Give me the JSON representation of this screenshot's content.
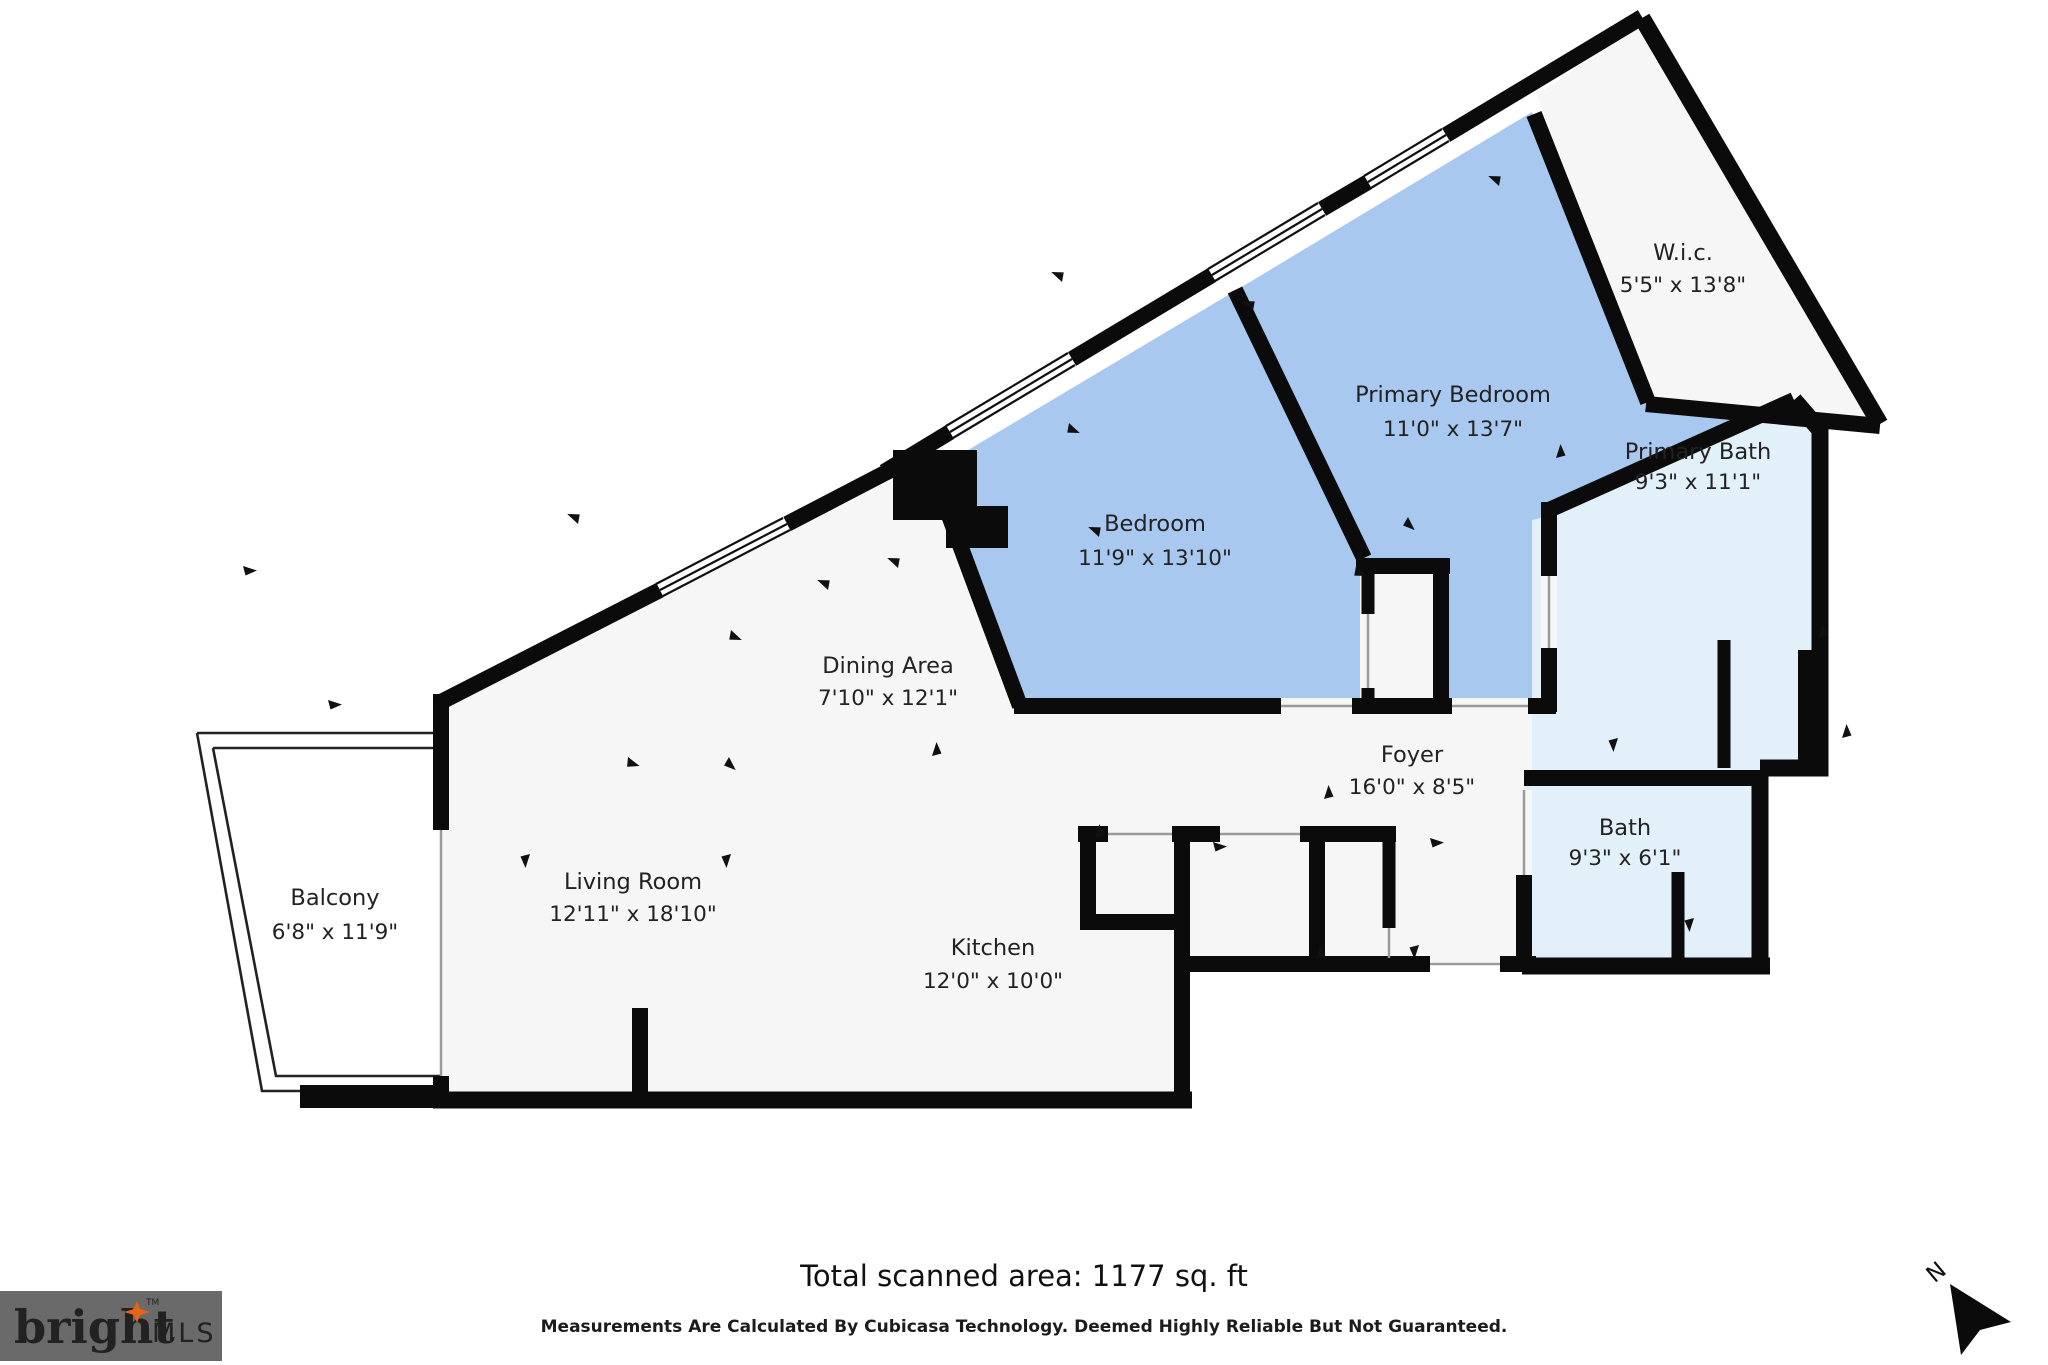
{
  "title": "Floor plan",
  "rooms": [
    {
      "id": "wic",
      "name": "W.i.c.",
      "dims": "5'5\" x 13'8\""
    },
    {
      "id": "primary-bedroom",
      "name": "Primary Bedroom",
      "dims": "11'0\" x 13'7\""
    },
    {
      "id": "bedroom",
      "name": "Bedroom",
      "dims": "11'9\" x 13'10\""
    },
    {
      "id": "dining-area",
      "name": "Dining Area",
      "dims": "7'10\" x 12'1\""
    },
    {
      "id": "living-room",
      "name": "Living Room",
      "dims": "12'11\" x 18'10\""
    },
    {
      "id": "kitchen",
      "name": "Kitchen",
      "dims": "12'0\" x 10'0\""
    },
    {
      "id": "balcony",
      "name": "Balcony",
      "dims": "6'8\" x 11'9\""
    },
    {
      "id": "foyer",
      "name": "Foyer",
      "dims": "16'0\" x 8'5\""
    },
    {
      "id": "primary-bath",
      "name": "Primary Bath",
      "dims": "9'3\" x 11'1\""
    },
    {
      "id": "bath",
      "name": "Bath",
      "dims": "9'3\" x 6'1\""
    }
  ],
  "footer": {
    "total_area": "Total scanned area: 1177 sq. ft",
    "disclaimer": "Measurements Are Calculated By Cubicasa Technology. Deemed Highly Reliable But Not Guaranteed."
  },
  "logo": {
    "brand": "bright",
    "suffix": "MLS",
    "tm": "TM"
  },
  "compass": {
    "label": "N"
  },
  "colors": {
    "bedroom_fill": "#a9c8ef",
    "bath_fill": "#e2f0fa",
    "room_fill": "#f6f6f6",
    "wall": "#0b0b0b",
    "logo_bg": "#6a6a6a",
    "logo_text": "#efe9dc",
    "logo_star": "#e8650d",
    "logo_mls": "#c6c6c6"
  }
}
